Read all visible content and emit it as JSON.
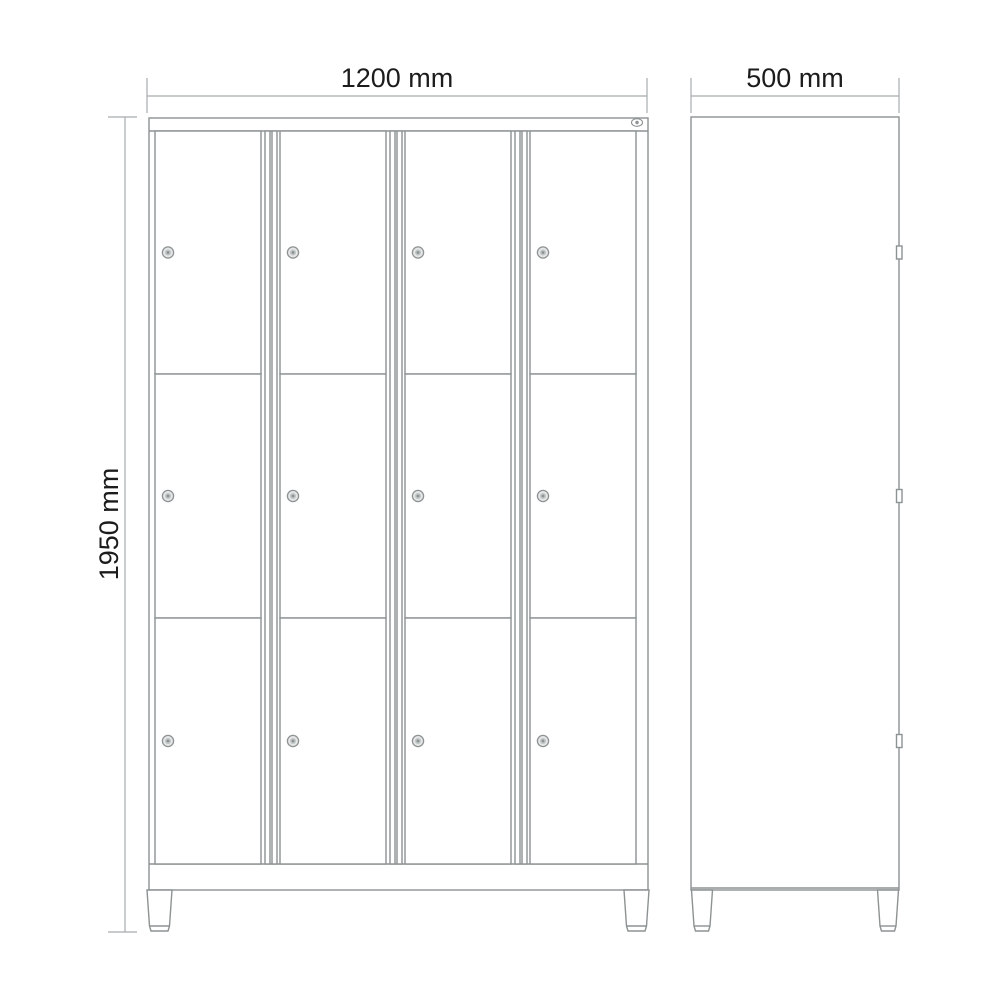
{
  "drawing": {
    "description": "Technical drawing of a 12-compartment locker cabinet: front elevation and side elevation with overall dimensions",
    "dimensions": {
      "width_label": "1200 mm",
      "depth_label": "500 mm",
      "height_label": "1950 mm"
    },
    "front_view": {
      "columns": 4,
      "rows": 3,
      "compartments": 12,
      "feet": 2
    },
    "side_view": {
      "latches": 3,
      "feet": 2
    },
    "icons": {
      "lock": "lock-icon",
      "badge": "brand-badge-icon"
    },
    "colors": {
      "outline": "#8d9292",
      "dimension": "#a7acac",
      "text": "#1c1c1c",
      "lock_fill": "#e6e6e6",
      "background": "#ffffff"
    }
  }
}
